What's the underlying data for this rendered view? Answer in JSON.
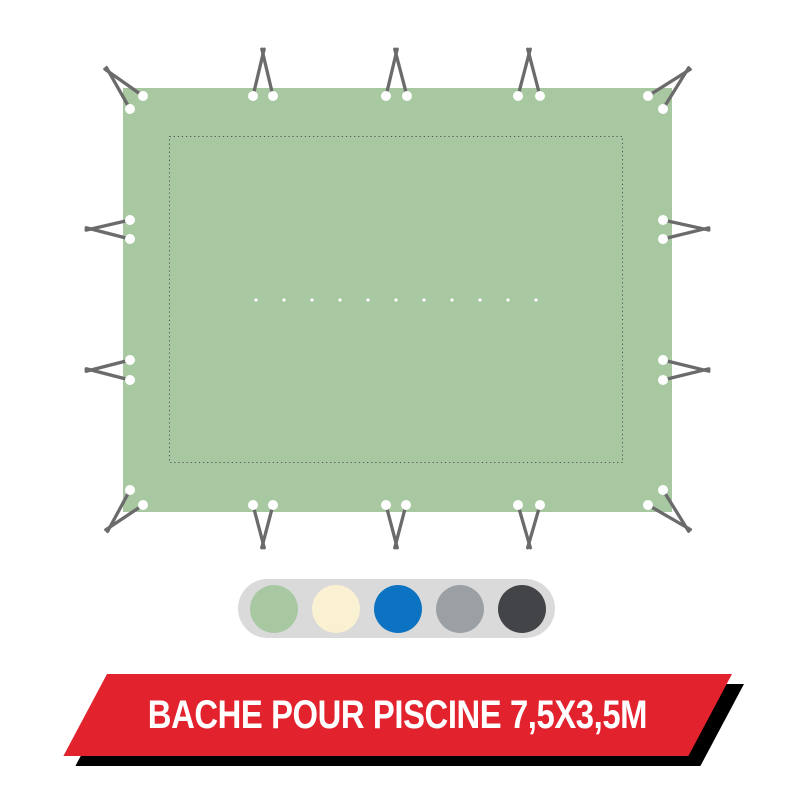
{
  "banner": {
    "label": "BACHE POUR PISCINE 7,5X3,5M",
    "background_color": "#e2232e",
    "shadow_color": "#000000",
    "text_color": "#ffffff"
  },
  "swatch_picker": {
    "background_color": "#dadada",
    "options": [
      {
        "name": "sage-green",
        "color": "#a8c8a2"
      },
      {
        "name": "cream",
        "color": "#faf0d2"
      },
      {
        "name": "blue",
        "color": "#0b73c1"
      },
      {
        "name": "gray",
        "color": "#9aa0a4"
      },
      {
        "name": "charcoal",
        "color": "#424447"
      }
    ]
  },
  "tarp": {
    "fabric_color": "#a8c8a2",
    "cord_color": "#6b6b6b",
    "eyelet_color": "#ffffff",
    "stitch_color": "#5a5a5a",
    "rect": {
      "x": 123,
      "y": 88,
      "width": 549,
      "height": 424
    },
    "stitch_inset_rect": {
      "x": 169.5,
      "y": 136.5,
      "width": 453,
      "height": 326
    },
    "center_fold_dots": {
      "count": 11,
      "x_start": 256,
      "y": 300,
      "spacing": 28,
      "size": 3
    },
    "eyelet_radius": 5,
    "cord_width": 3.3,
    "cord_tail": 5,
    "fasteners": [
      {
        "name": "corner-top-left",
        "eyelets": [
          [
            143,
            96
          ],
          [
            130,
            109
          ]
        ],
        "vertex": [
          109,
          72
        ]
      },
      {
        "name": "top-left-pair",
        "eyelets": [
          [
            253,
            96
          ],
          [
            273,
            96
          ]
        ],
        "vertex": [
          263,
          54
        ]
      },
      {
        "name": "top-center-pair",
        "eyelets": [
          [
            386,
            96
          ],
          [
            407,
            96
          ]
        ],
        "vertex": [
          396,
          54
        ]
      },
      {
        "name": "top-right-pair",
        "eyelets": [
          [
            518,
            96
          ],
          [
            540,
            96
          ]
        ],
        "vertex": [
          529,
          54
        ]
      },
      {
        "name": "corner-top-right",
        "eyelets": [
          [
            648,
            96
          ],
          [
            663,
            109
          ]
        ],
        "vertex": [
          686,
          72
        ]
      },
      {
        "name": "left-upper-pair",
        "eyelets": [
          [
            130,
            220
          ],
          [
            130,
            239
          ]
        ],
        "vertex": [
          91,
          229
        ]
      },
      {
        "name": "left-lower-pair",
        "eyelets": [
          [
            130,
            360
          ],
          [
            130,
            380
          ]
        ],
        "vertex": [
          91,
          370
        ]
      },
      {
        "name": "right-upper-pair",
        "eyelets": [
          [
            663,
            220
          ],
          [
            663,
            239
          ]
        ],
        "vertex": [
          704,
          229
        ]
      },
      {
        "name": "right-lower-pair",
        "eyelets": [
          [
            663,
            360
          ],
          [
            663,
            380
          ]
        ],
        "vertex": [
          704,
          370
        ]
      },
      {
        "name": "corner-bottom-left",
        "eyelets": [
          [
            130,
            490
          ],
          [
            143,
            505
          ]
        ],
        "vertex": [
          110,
          527
        ]
      },
      {
        "name": "bottom-left-pair",
        "eyelets": [
          [
            253,
            505
          ],
          [
            273,
            505
          ]
        ],
        "vertex": [
          263,
          543
        ]
      },
      {
        "name": "bottom-center-pair",
        "eyelets": [
          [
            386,
            505
          ],
          [
            406,
            505
          ]
        ],
        "vertex": [
          396,
          543
        ]
      },
      {
        "name": "bottom-right-pair",
        "eyelets": [
          [
            518,
            505
          ],
          [
            540,
            505
          ]
        ],
        "vertex": [
          529,
          543
        ]
      },
      {
        "name": "corner-bottom-right",
        "eyelets": [
          [
            648,
            505
          ],
          [
            663,
            490
          ]
        ],
        "vertex": [
          686,
          527
        ]
      }
    ]
  }
}
